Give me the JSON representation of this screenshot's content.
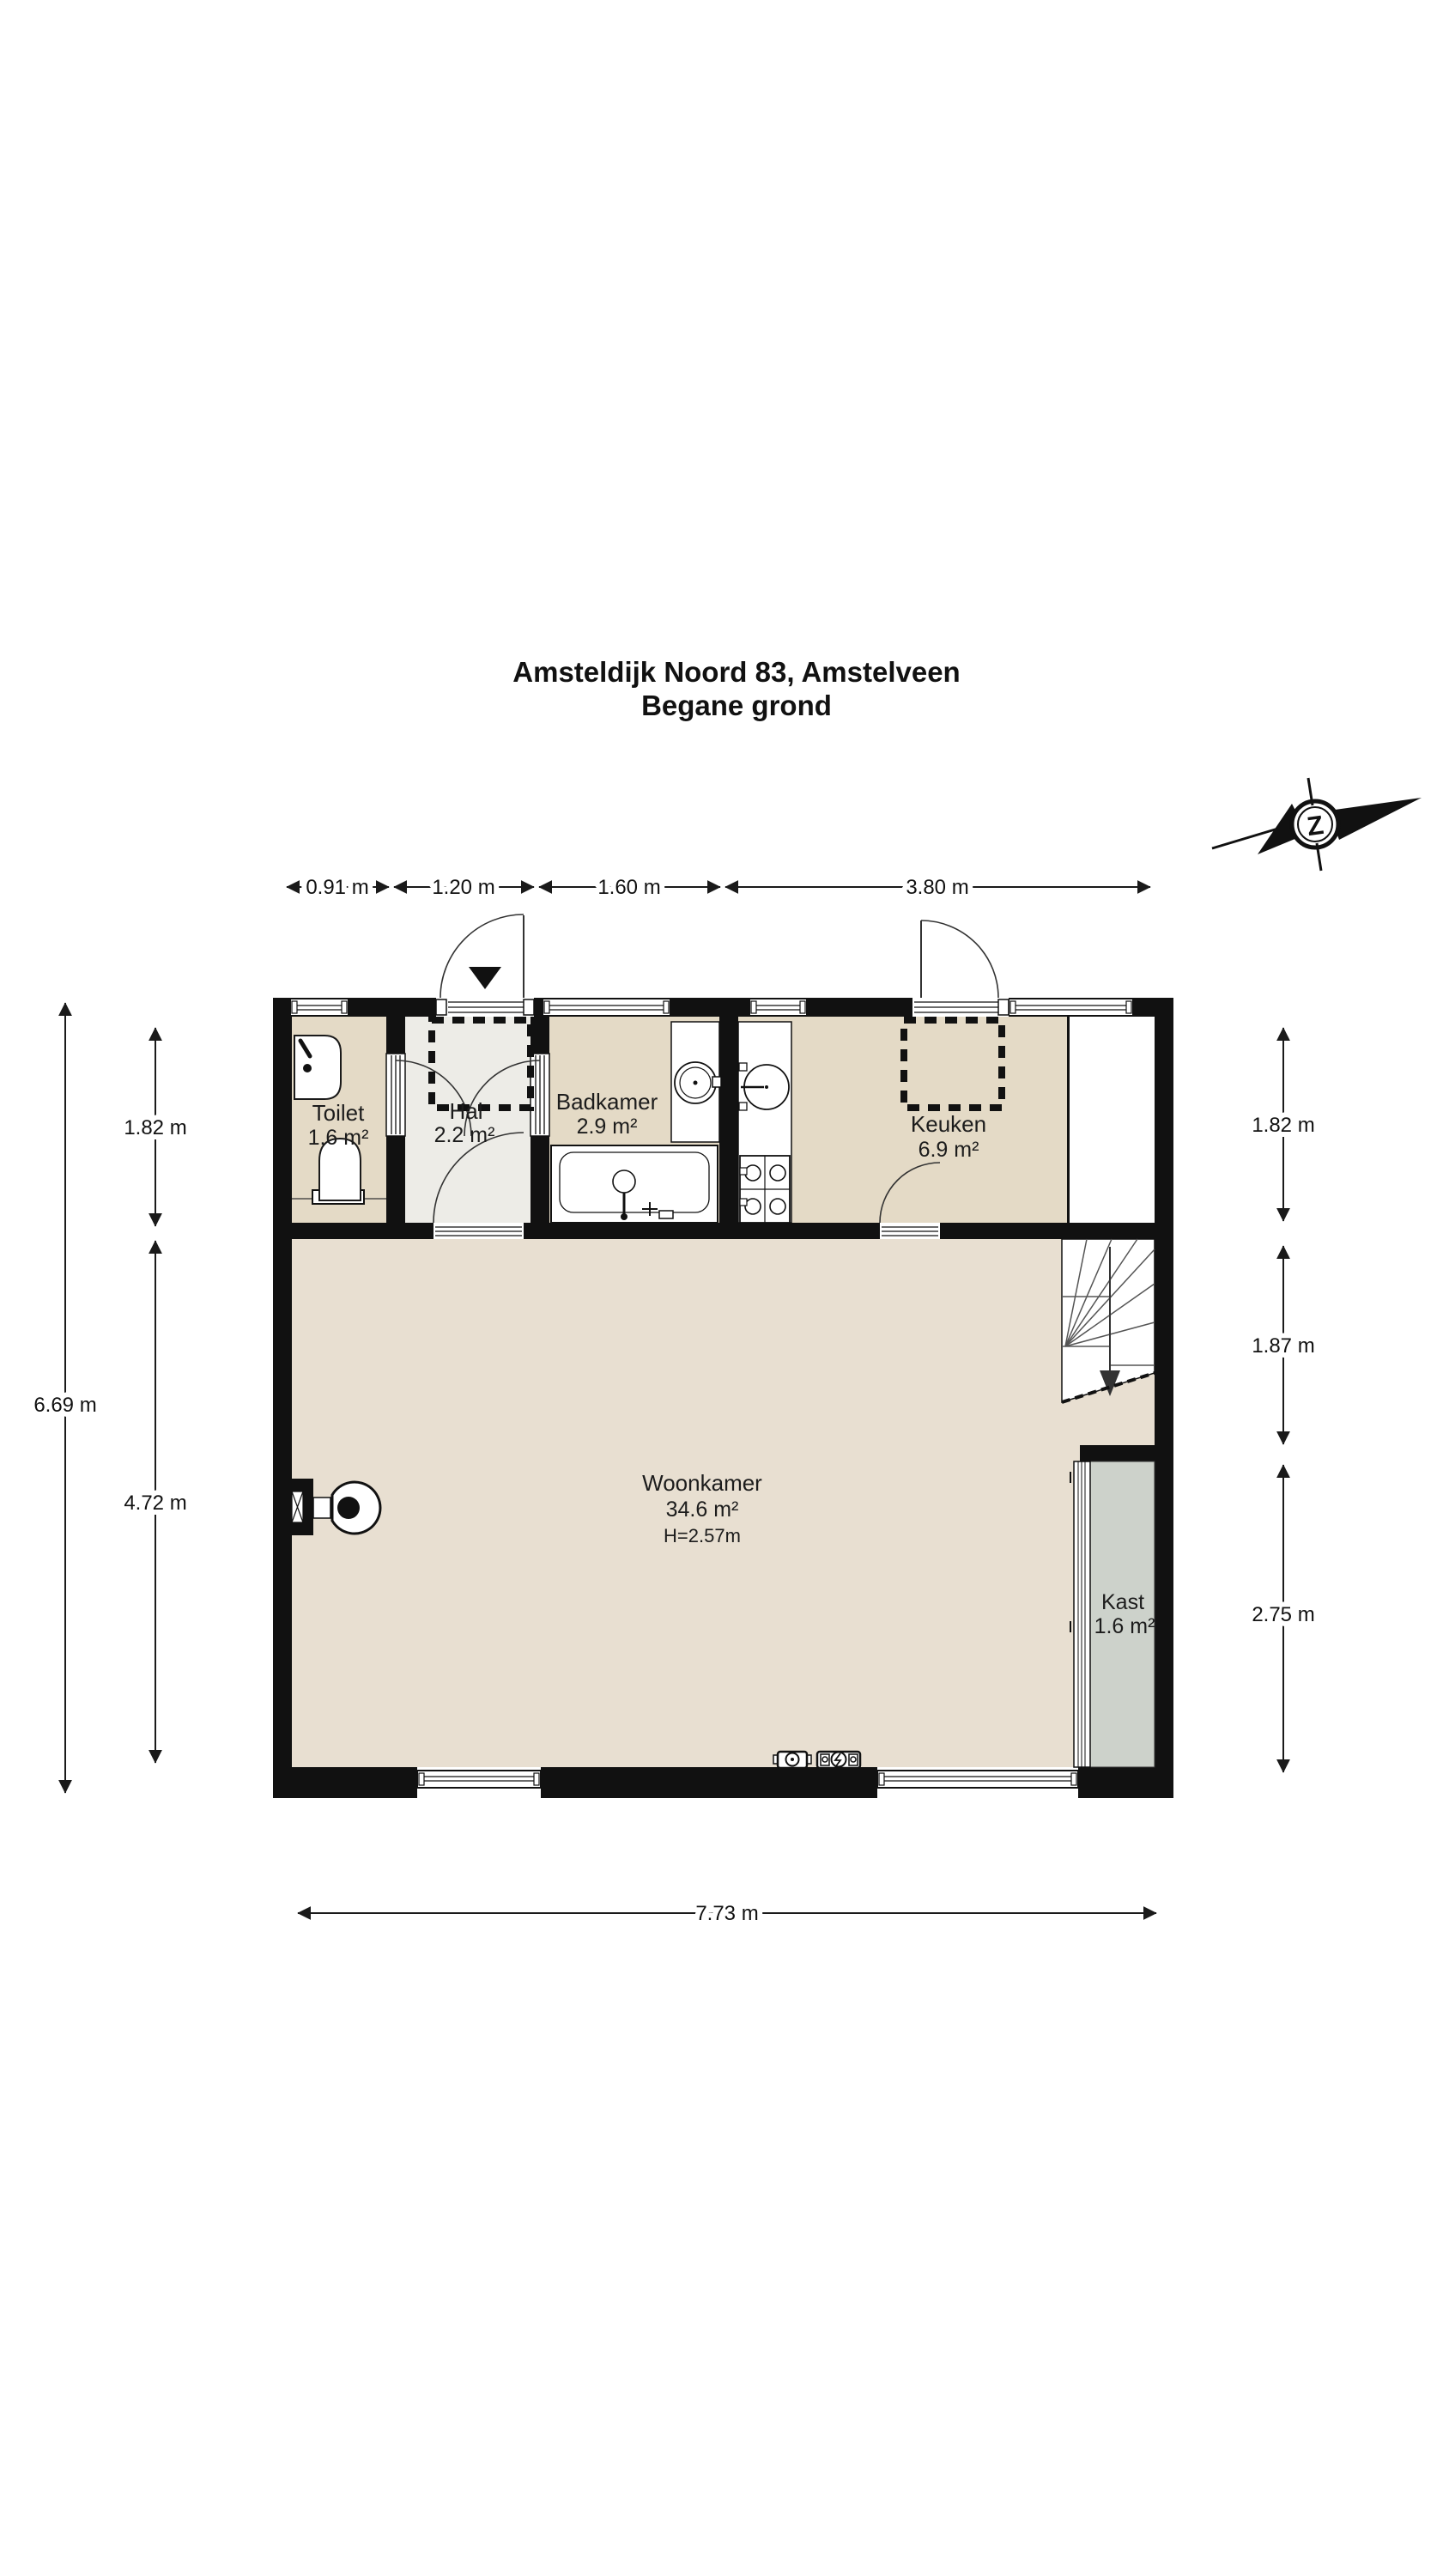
{
  "title": {
    "line1": "Amsteldijk Noord 83, Amstelveen",
    "line2": "Begane grond"
  },
  "compass": {
    "letter": "Z"
  },
  "rooms": {
    "toilet": {
      "name": "Toilet",
      "area": "1.6 m²"
    },
    "hal": {
      "name": "Hal",
      "area": "2.2 m²"
    },
    "badkamer": {
      "name": "Badkamer",
      "area": "2.9 m²"
    },
    "keuken": {
      "name": "Keuken",
      "area": "6.9 m²"
    },
    "woonkamer": {
      "name": "Woonkamer",
      "area": "34.6 m²",
      "height_note": "H=2.57m"
    },
    "kast": {
      "name": "Kast",
      "area": "1.6 m²"
    }
  },
  "dimensions": {
    "top": [
      "0.91 m",
      "1.20 m",
      "1.60 m",
      "3.80 m"
    ],
    "bottom": [
      "7.73 m"
    ],
    "left_outer": [
      "6.69 m"
    ],
    "left_inner": [
      "1.82 m",
      "4.72 m"
    ],
    "right": [
      "1.82 m",
      "1.87 m",
      "2.75 m"
    ]
  },
  "colors": {
    "background": "#ffffff",
    "wall_black": "#111111",
    "room_beige": "#e4dac6",
    "hall_grey": "#edece7",
    "living_beige": "#e8dfd1",
    "closet_grey": "#cdd2cb"
  }
}
